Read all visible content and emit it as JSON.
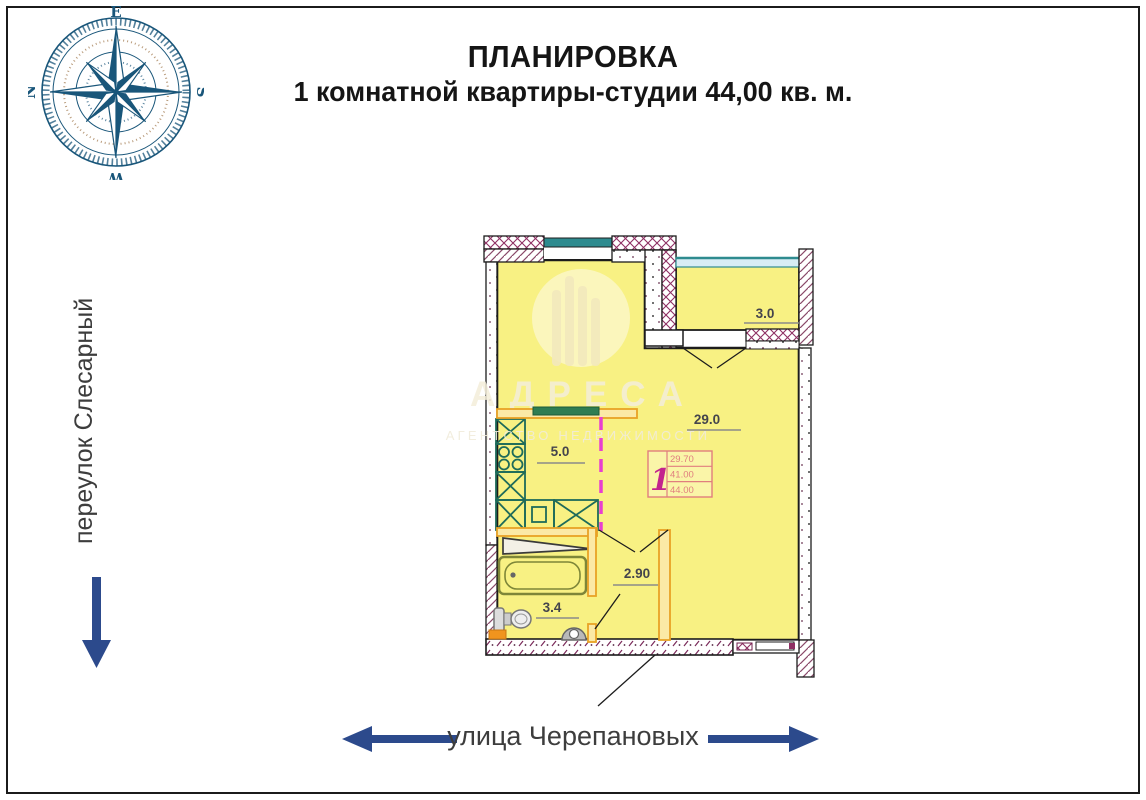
{
  "header": {
    "title": "ПЛАНИРОВКА",
    "subtitle": "1 комнатной квартиры-студии 44,00 кв. м."
  },
  "compass": {
    "top": "E",
    "right": "S",
    "bottom": "W",
    "left": "N"
  },
  "streets": {
    "left": "переулок Слесарный",
    "bottom": "улица Черепановых"
  },
  "watermark": {
    "name": "АДРЕСА",
    "tagline": "АГЕНТСТВО НЕДВИЖИМОСТИ"
  },
  "plan": {
    "labels": {
      "balcony": "3.0",
      "living": "29.0",
      "kitchen": "5.0",
      "hall": "2.90",
      "bathroom": "3.4"
    },
    "stamp": {
      "number": "1",
      "row1": "29.70",
      "row2": "41.00",
      "row3": "44.00"
    },
    "colors": {
      "room_fill": "#f8f183",
      "wall": "#1c1c1c",
      "hatch_maroon": "#8e2f63",
      "window_teal": "#2e8b8f",
      "glazing_blue": "#d8edf4",
      "kitchen_green": "#1e6b5a",
      "partition_orange": "#e8a225",
      "dash_magenta": "#e83fd0",
      "stamp_pink": "#e07e7e",
      "arrow_blue": "#2c4a8c",
      "compass_blue": "#19567a"
    }
  }
}
